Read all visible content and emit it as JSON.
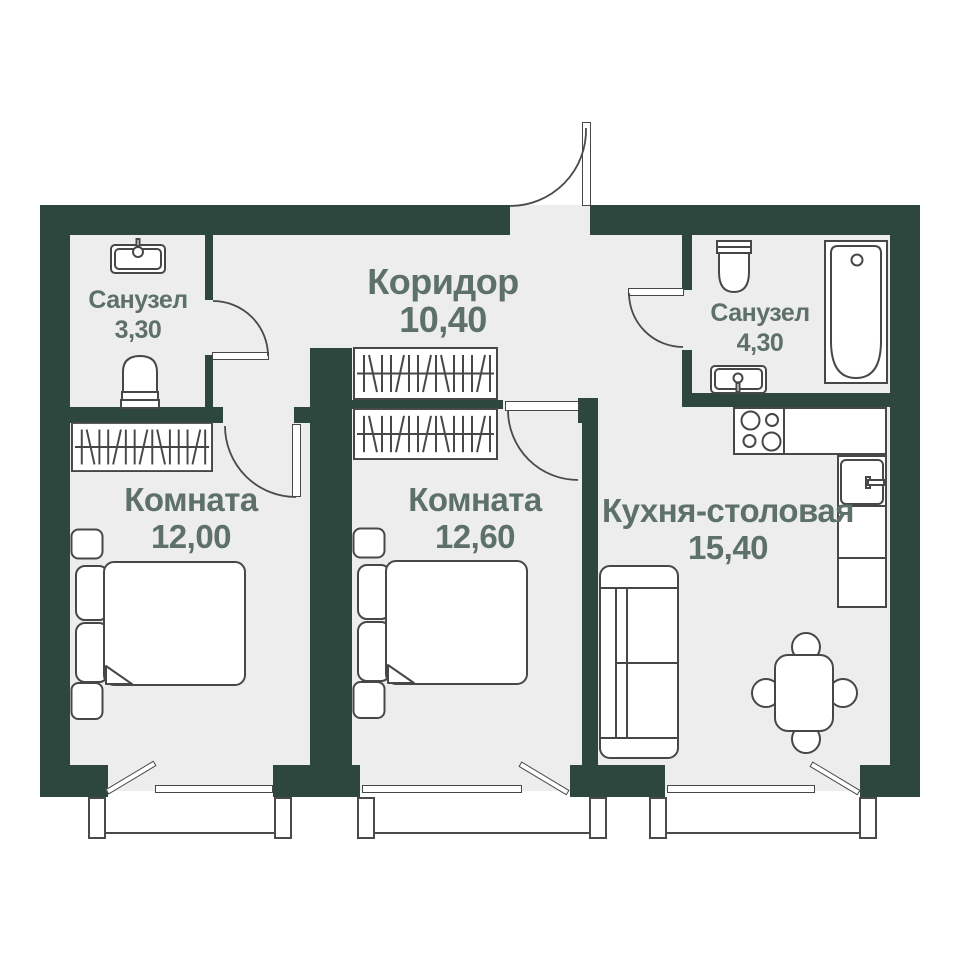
{
  "rooms": [
    {
      "id": "bathroom-1",
      "name": "Санузел",
      "area": "3,30"
    },
    {
      "id": "corridor",
      "name": "Коридор",
      "area": "10,40"
    },
    {
      "id": "bathroom-2",
      "name": "Санузел",
      "area": "4,30"
    },
    {
      "id": "room-1",
      "name": "Комната",
      "area": "12,00"
    },
    {
      "id": "room-2",
      "name": "Комната",
      "area": "12,60"
    },
    {
      "id": "kitchen-dining",
      "name": "Кухня-столовая",
      "area": "15,40"
    }
  ],
  "colors": {
    "wall": "#2d473e",
    "floor": "#ecedec",
    "label_text": "#5e706b",
    "outline": "#474747"
  }
}
